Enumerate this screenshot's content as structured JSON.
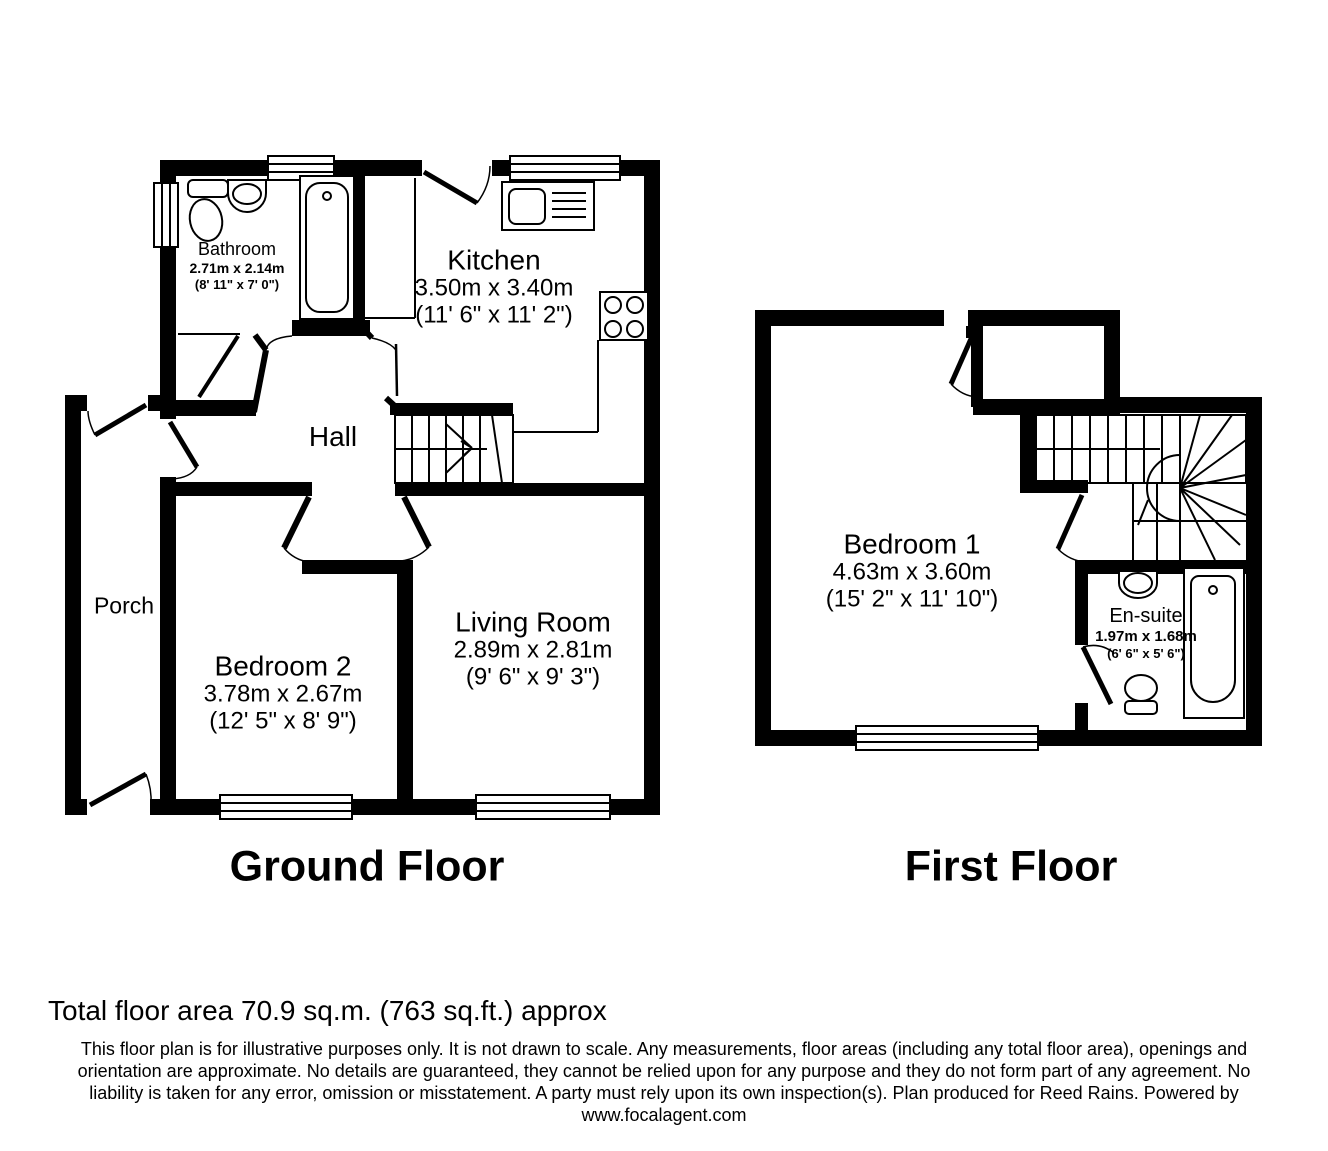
{
  "plan": {
    "floors": [
      {
        "title": "Ground Floor",
        "rooms": [
          {
            "name": "Bathroom",
            "metric": "2.71m x 2.14m",
            "imperial": "(8' 11\" x 7' 0\")"
          },
          {
            "name": "Kitchen",
            "metric": "3.50m x 3.40m",
            "imperial": "(11' 6\" x 11' 2\")"
          },
          {
            "name": "Hall",
            "metric": "",
            "imperial": ""
          },
          {
            "name": "Porch",
            "metric": "",
            "imperial": ""
          },
          {
            "name": "Bedroom 2",
            "metric": "3.78m x 2.67m",
            "imperial": "(12' 5\" x 8' 9\")"
          },
          {
            "name": "Living Room",
            "metric": "2.89m x 2.81m",
            "imperial": "(9' 6\" x 9' 3\")"
          }
        ]
      },
      {
        "title": "First Floor",
        "rooms": [
          {
            "name": "Bedroom 1",
            "metric": "4.63m x 3.60m",
            "imperial": "(15' 2\" x 11' 10\")"
          },
          {
            "name": "En-suite",
            "metric": "1.97m x 1.68m",
            "imperial": "(6' 6\" x 5' 6\")"
          }
        ]
      }
    ]
  },
  "footer": {
    "total_area": "Total floor area 70.9 sq.m. (763 sq.ft.) approx",
    "disclaimer_lines": [
      "This floor plan is for illustrative purposes only. It is not drawn to scale. Any measurements, floor areas (including any total floor area), openings and",
      "orientation are approximate. No details are guaranteed, they cannot be relied upon for any purpose and they do not form part of any agreement. No",
      "liability is taken for any error, omission or misstatement. A party must rely upon its own inspection(s). Plan produced for Reed Rains. Powered by",
      "www.focalagent.com"
    ]
  },
  "colors": {
    "wall": "#000000",
    "background": "#ffffff",
    "text": "#000000"
  }
}
